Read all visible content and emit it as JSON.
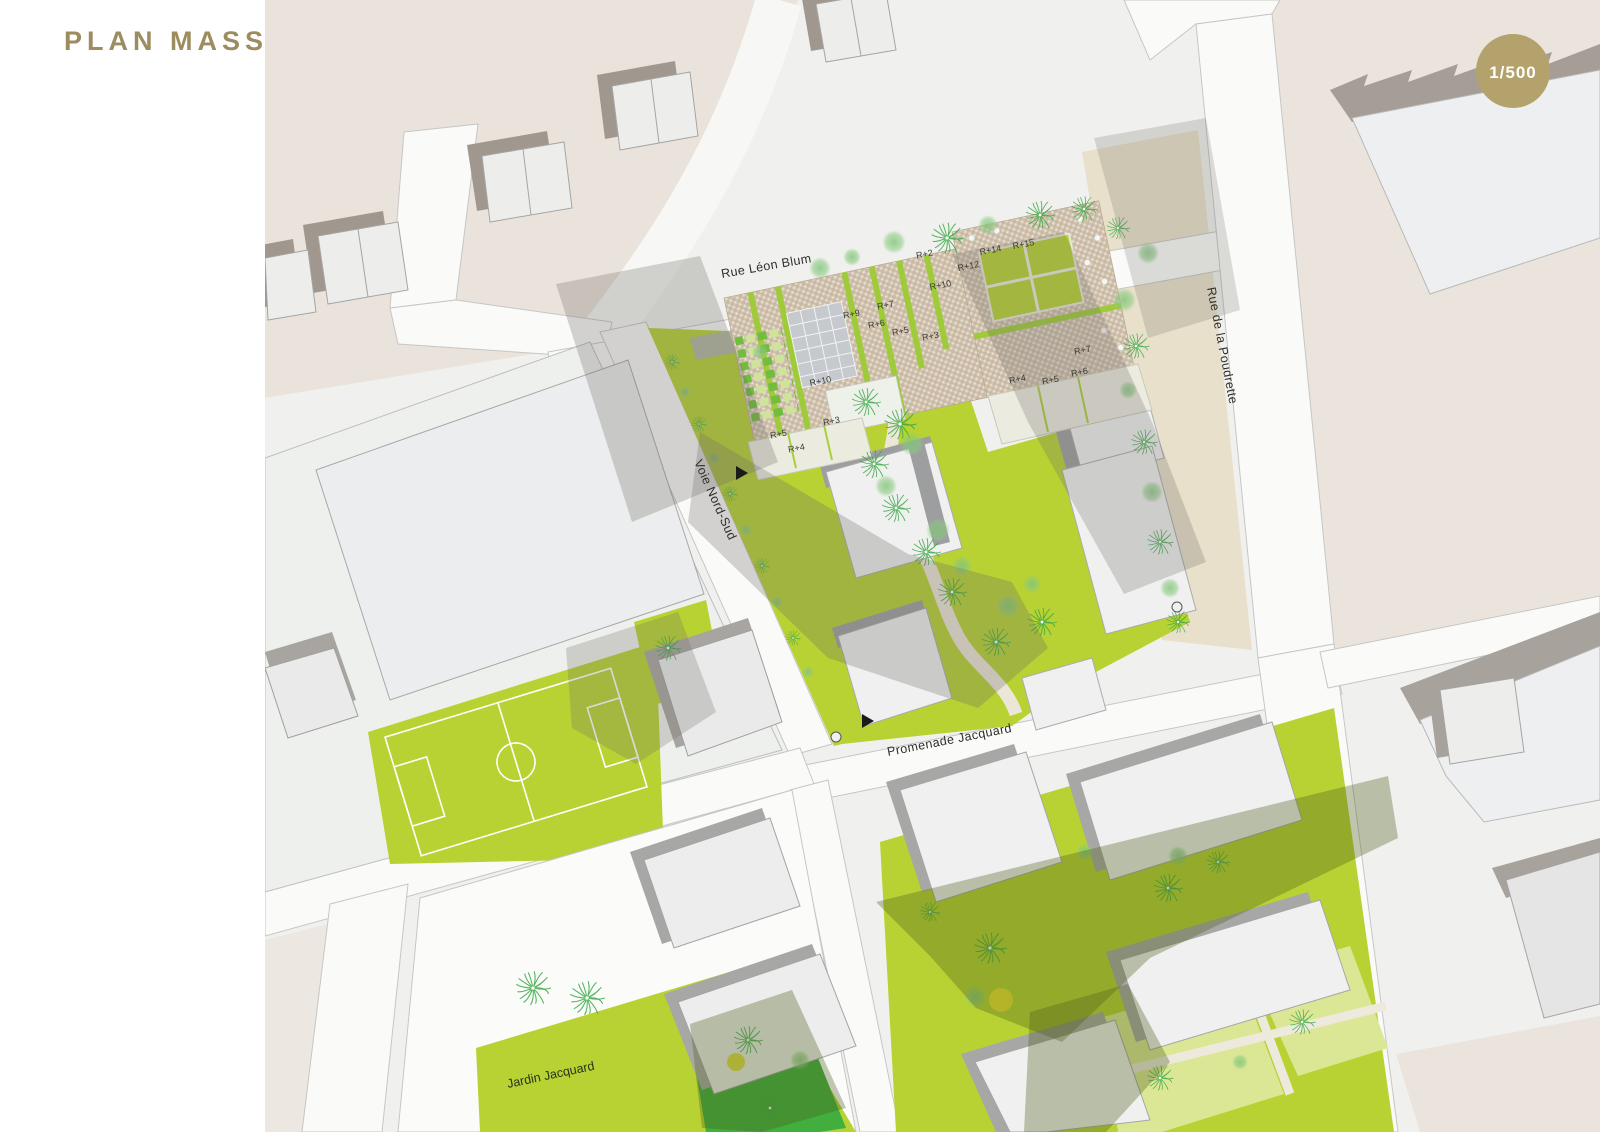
{
  "title": "PLAN MASSE",
  "scale_badge": "1/500",
  "streets": {
    "rue_leon_blum": "Rue Léon Blum",
    "rue_de_la_poudrette": "Rue de la Poudrette",
    "voie_nord_sud": "Voie Nord-Sud",
    "promenade_jacquard": "Promenade Jacquard"
  },
  "places": {
    "jardin_jacquard": "Jardin Jacquard"
  },
  "building_heights": [
    {
      "label": "R+2"
    },
    {
      "label": "R+14"
    },
    {
      "label": "R+15"
    },
    {
      "label": "R+12"
    },
    {
      "label": "R+10"
    },
    {
      "label": "R+7"
    },
    {
      "label": "R+9"
    },
    {
      "label": "R+6"
    },
    {
      "label": "R+5"
    },
    {
      "label": "R+3"
    },
    {
      "label": "R+10"
    },
    {
      "label": "R+3"
    },
    {
      "label": "R+5"
    },
    {
      "label": "R+4"
    },
    {
      "label": "R+4"
    },
    {
      "label": "R+5"
    },
    {
      "label": "R+6"
    },
    {
      "label": "R+7"
    }
  ],
  "colors": {
    "title": "#9c8c5f",
    "badge": "#b3a26b",
    "lime_green": "#b7d232",
    "dark_green": "#41ae3e",
    "roof_tan": "#c9b9a4",
    "beige_district": "#eae3db",
    "building_gray": "#ededee",
    "shadow_gray": "#6b6763"
  }
}
